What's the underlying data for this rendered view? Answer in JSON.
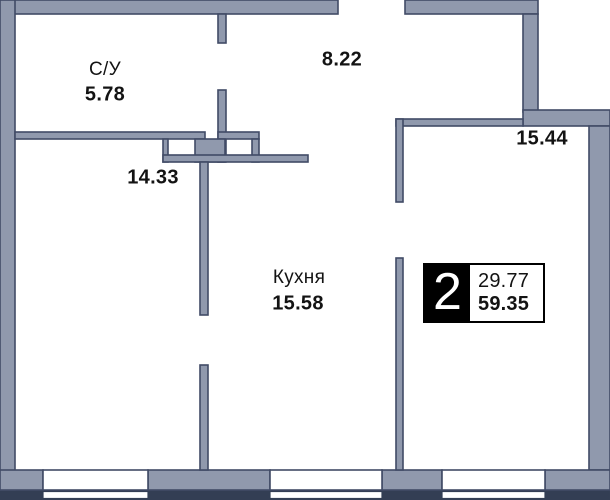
{
  "plan": {
    "title": "apartment-floor-plan",
    "rooms": [
      {
        "id": "bathroom",
        "label": "С/У",
        "area": "5.78"
      },
      {
        "id": "hallway",
        "label": "",
        "area": "8.22"
      },
      {
        "id": "room-1",
        "label": "",
        "area": "14.33"
      },
      {
        "id": "kitchen",
        "label": "Кухня",
        "area": "15.58"
      },
      {
        "id": "room-2",
        "label": "",
        "area": "15.44"
      }
    ],
    "badge": {
      "rooms_count": "2",
      "living_area": "29.77",
      "total_area": "59.35"
    },
    "colors": {
      "wall_fill": "#9099ad",
      "wall_outline": "#414b66",
      "basement_band": "#333e54",
      "badge_bg": "#000000",
      "badge_text": "#ffffff",
      "text": "#131313",
      "background": "#ffffff"
    }
  }
}
